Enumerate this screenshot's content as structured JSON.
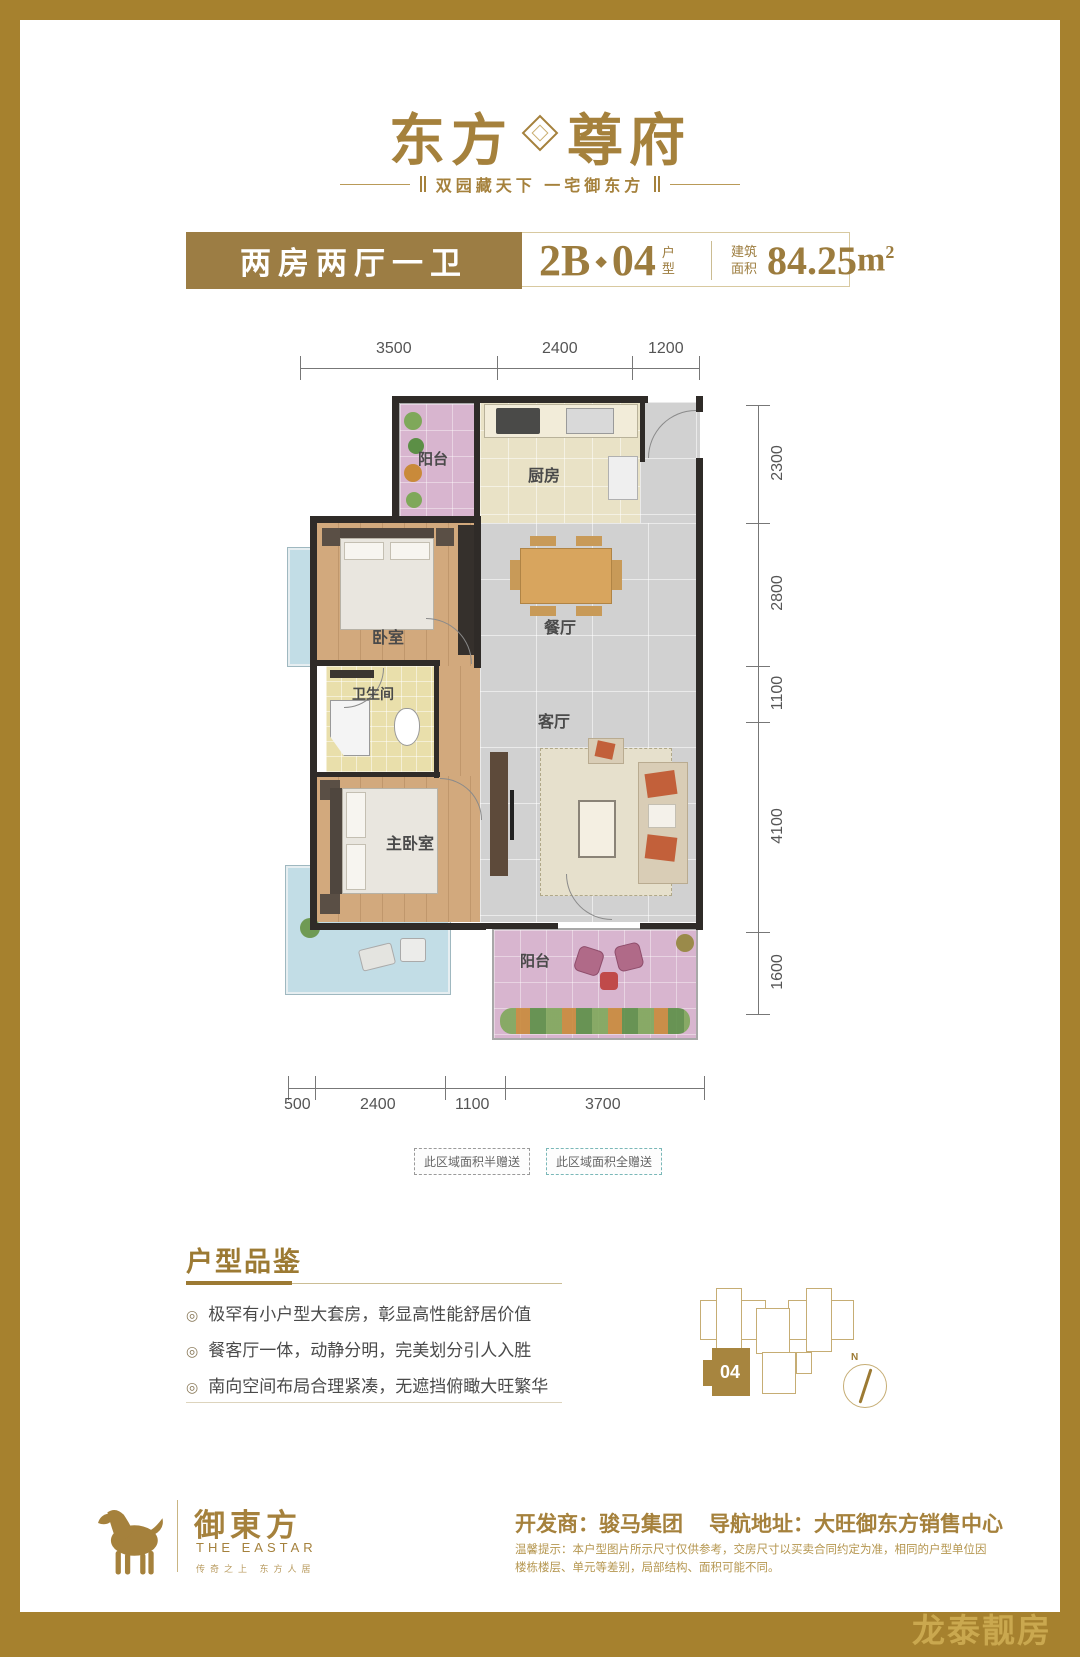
{
  "brand": {
    "logo_left": "东方",
    "logo_right": "尊府",
    "tagline": "双园藏天下  一宅御东方"
  },
  "header": {
    "unit_type": "两房两厅一卫",
    "code_prefix": "2B",
    "code_separator": "◆",
    "code_number": "04",
    "code_suffix": "户型",
    "area_label": "建筑面积",
    "area_value": "84.25",
    "area_unit_base": "m",
    "area_unit_sup": "2"
  },
  "floorplan": {
    "dims_top": [
      "3500",
      "2400",
      "1200"
    ],
    "dims_right": [
      "2300",
      "2800",
      "1100",
      "4100",
      "1600"
    ],
    "dims_bottom": [
      "500",
      "2400",
      "1100",
      "3700"
    ],
    "rooms": {
      "balcony_top": "阳台",
      "kitchen": "厨房",
      "bedroom": "卧室",
      "dining": "餐厅",
      "bathroom": "卫生间",
      "living": "客厅",
      "master": "主卧室",
      "balcony_bottom": "阳台"
    },
    "notes": [
      "此区域面积半赠送",
      "此区域面积全赠送"
    ]
  },
  "highlights": {
    "title": "户型品鉴",
    "bullet": "◎",
    "items": [
      "极罕有小户型大套房，彰显高性能舒居价值",
      "餐客厅一体，动静分明，完美划分引人入胜",
      "南向空间布局合理紧凑，无遮挡俯瞰大旺繁华"
    ]
  },
  "keyplan": {
    "unit_label": "04",
    "compass_label": "N"
  },
  "footer": {
    "logo_cn": "御東方",
    "logo_en": "THE EASTAR",
    "logo_tagline": "传奇之上 东方人居",
    "developer": "开发商：骏马集团",
    "address": "导航地址：大旺御东方销售中心",
    "disclaimer": "温馨提示：本户型图片所示尺寸仅供参考，交房尺寸以买卖合同约定为准，相同的户型单位因楼栋楼层、单元等差别，局部结构、面积可能不同。"
  },
  "watermark": "龙泰靓房",
  "colors": {
    "frame_gold": "#a6812e",
    "brand_gold": "#a5813c",
    "header_box_gold": "#9c7d44",
    "wall_dark": "#2f2b28",
    "wood_floor": "#d2a97d",
    "tile_gray": "#d1d1d1",
    "kitchen_cream": "#e9e2c6",
    "bath_yellow": "#e9dfab",
    "balcony_pink": "#d8b5cf",
    "balcony_blue": "#c2dde6"
  }
}
